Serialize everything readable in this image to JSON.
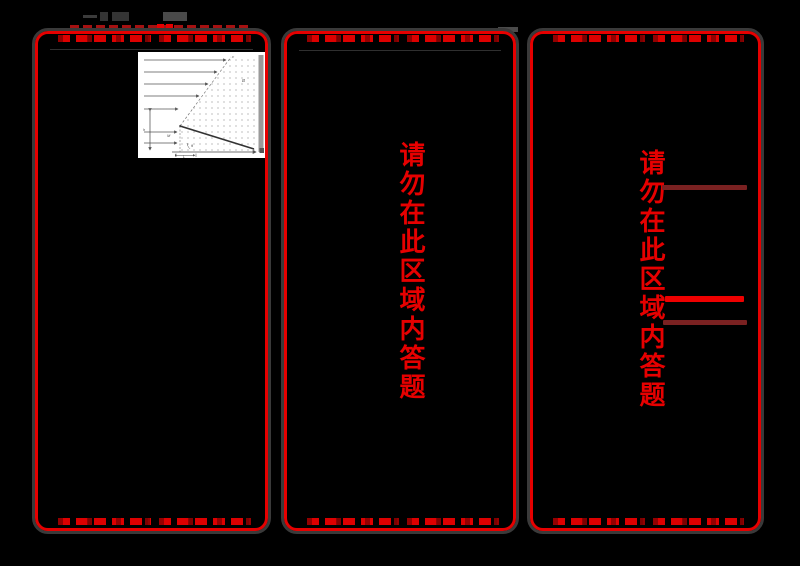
{
  "document": {
    "kind": "scanned tri-fold answer sheet",
    "background": "#000000",
    "colors": {
      "panel_border_red": "#e60000",
      "timing_mark_red": "#dd0000",
      "dark_red_line": "#7a2121",
      "bright_red_line": "#ee0000",
      "outline_gray": "#3a3a3a"
    }
  },
  "panels": {
    "left": {
      "warning": ""
    },
    "middle": {
      "warning": "请勿在此区域内答题"
    },
    "right": {
      "warning": "请勿在此区域内答题"
    }
  },
  "diagram": {
    "description": "physics figure: incline in uniform field region",
    "labels": {
      "field": "B",
      "height": "h",
      "angle": "θ",
      "mass": "M",
      "base": "L",
      "top": "v"
    }
  }
}
